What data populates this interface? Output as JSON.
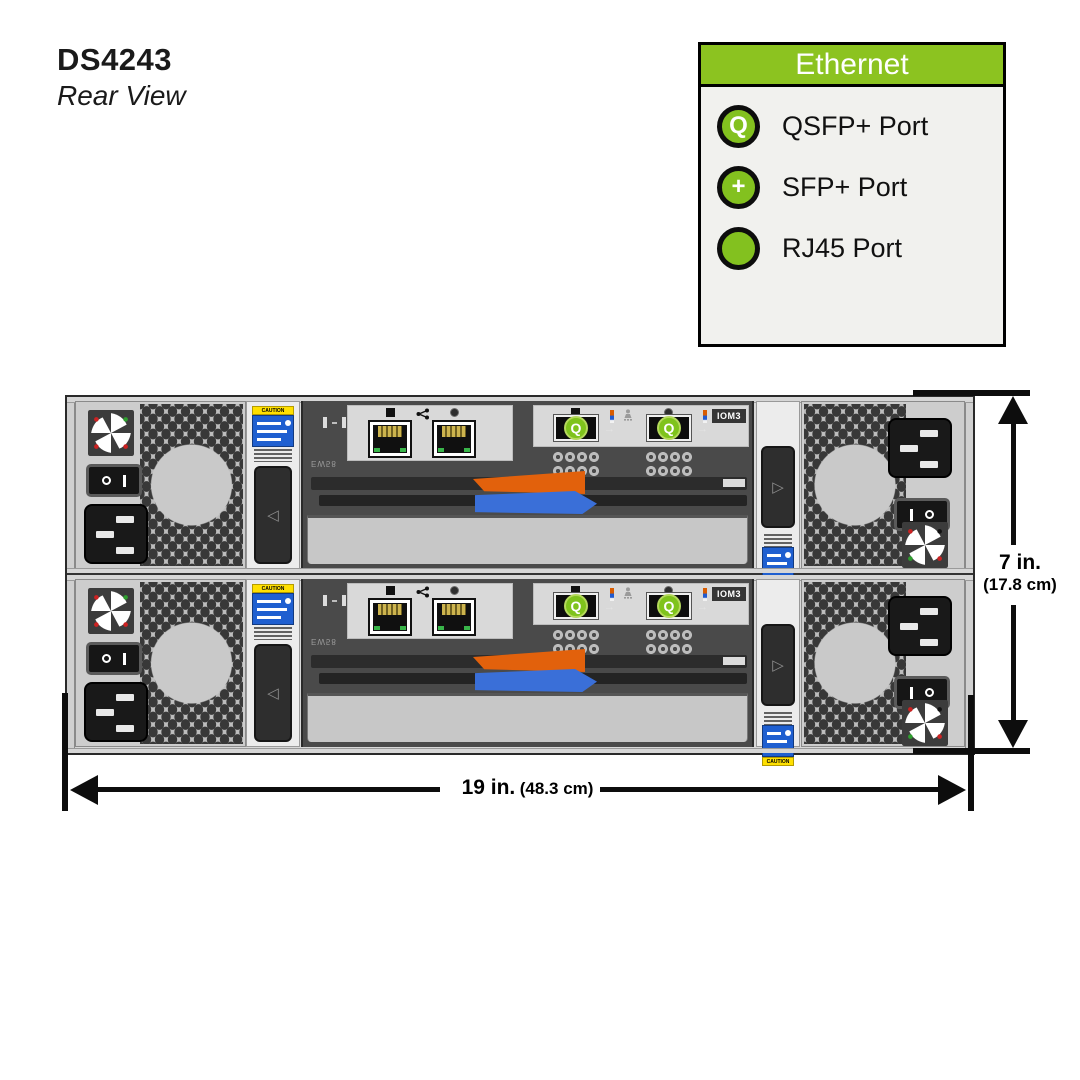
{
  "title": {
    "model": "DS4243",
    "view": "Rear View"
  },
  "legend": {
    "header": "Ethernet",
    "items": [
      {
        "symbol": "Q",
        "label": "QSFP+ Port"
      },
      {
        "symbol": "+",
        "label": "SFP+ Port"
      },
      {
        "symbol": "",
        "label": "RJ45 Port"
      }
    ]
  },
  "device": {
    "iom_label": "IOM3",
    "qsfp_symbol": "Q",
    "caution_text": "CAUTION",
    "board_code": "EW58"
  },
  "dimensions": {
    "height_primary": "7 in.",
    "height_secondary": "(17.8 cm)",
    "width_primary": "19 in.",
    "width_secondary": "(48.3 cm)"
  },
  "colors": {
    "legend_green": "#8cc320",
    "port_green": "#7fc31c",
    "latch_orange": "#e2610c",
    "latch_blue": "#3a6fd8",
    "caution_yellow": "#ffe000",
    "label_blue": "#1f5fd0"
  }
}
